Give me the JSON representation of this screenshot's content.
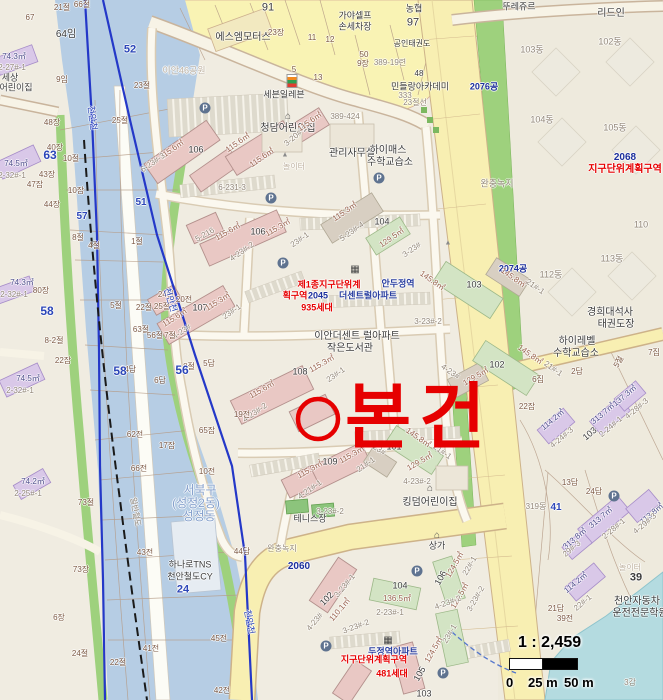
{
  "annotation": {
    "subject": "본건",
    "color": "#e60000"
  },
  "scale": {
    "ratio": "1 : 2,459",
    "t0": "0",
    "t25": "25 m",
    "t50": "50 m"
  },
  "colors": {
    "river_zone": "#b6cde4",
    "boundary_line": "#2438c8",
    "buffer_green": "#9ed17d",
    "road_yellow": "#f8efb2",
    "apartment_pink": "#e9c8c4",
    "building_purple": "#d9c8e8",
    "annotation_red": "#e60000",
    "water": "#b4dbe0",
    "background": "#f0ece1"
  },
  "label_format": [
    "text",
    "x",
    "y",
    "color",
    "size",
    "rotation",
    "bold"
  ],
  "labels": [
    [
      "91",
      268,
      8,
      "dark",
      11,
      0,
      0
    ],
    [
      "66절",
      82,
      5
    ],
    [
      "21절",
      62,
      8
    ],
    [
      "67",
      30,
      18
    ],
    [
      "64임",
      66,
      35,
      "dark",
      10
    ],
    [
      "에스엠모터스",
      243,
      38,
      "dark",
      10
    ],
    [
      "가야셀프",
      355,
      16,
      "dark",
      9
    ],
    [
      "손세차장",
      355,
      27,
      "dark",
      9
    ],
    [
      "농협",
      414,
      9,
      "dark",
      9
    ],
    [
      "97",
      413,
      23,
      "dark",
      11
    ],
    [
      "뚜레쥬르",
      519,
      7,
      "dark",
      9
    ],
    [
      "리드인",
      611,
      14,
      "dark",
      10
    ],
    [
      "공인태권도",
      412,
      44,
      "dark",
      8
    ],
    [
      "50",
      364,
      55
    ],
    [
      "9장",
      363,
      64
    ],
    [
      "389-19련",
      390,
      63,
      "gray"
    ],
    [
      "48",
      419,
      74,
      "dark"
    ],
    [
      "민들랑아카데미",
      420,
      87,
      "dark",
      9
    ],
    [
      "333",
      405,
      96,
      "gray"
    ],
    [
      "23절선",
      415,
      103,
      "gray"
    ],
    [
      "23장",
      276,
      33
    ],
    [
      "11",
      312,
      38
    ],
    [
      "12",
      330,
      40
    ],
    [
      "5",
      294,
      70
    ],
    [
      "13",
      318,
      78
    ],
    [
      "세븐일레븐",
      284,
      95,
      "dark",
      9
    ],
    [
      "이안46공원",
      184,
      71,
      "faint",
      9
    ],
    [
      "102동",
      610,
      42,
      "gray",
      9
    ],
    [
      "103동",
      532,
      50,
      "gray",
      9
    ],
    [
      "104동",
      542,
      120,
      "gray",
      9
    ],
    [
      "105동",
      615,
      128,
      "gray",
      9
    ],
    [
      "2076공",
      484,
      87,
      "navy",
      9,
      0,
      1
    ],
    [
      "완충녹지",
      497,
      184,
      "gray",
      9
    ],
    [
      "청담어린이집",
      288,
      129,
      "dark",
      10
    ],
    [
      "389-424",
      345,
      117,
      "gray"
    ],
    [
      "관리사무실",
      352,
      154,
      "dark",
      10
    ],
    [
      "하이매스",
      388,
      151,
      "dark",
      10
    ],
    [
      "수학교습소",
      390,
      163,
      "dark",
      10
    ],
    [
      "놀이터",
      294,
      167,
      "faint",
      8
    ],
    [
      "110",
      641,
      225,
      "gray",
      9
    ],
    [
      "2074공",
      513,
      269,
      "navy",
      9,
      0,
      1
    ],
    [
      "112동",
      551,
      275,
      "gray",
      9
    ],
    [
      "113동",
      612,
      259,
      "gray",
      9
    ],
    [
      "2068",
      625,
      158,
      "navy",
      10,
      0,
      1
    ],
    [
      "지구단위계획구역",
      625,
      170,
      "red",
      10,
      0,
      1
    ],
    [
      "경희대석사",
      610,
      313,
      "dark",
      10
    ],
    [
      "태권도장",
      616,
      325,
      "dark",
      10
    ],
    [
      "하이레벨",
      577,
      342,
      "dark",
      10
    ],
    [
      "수학교습소",
      576,
      354,
      "dark",
      10
    ],
    [
      "115.6㎡",
      172,
      150,
      "area",
      8,
      -35
    ],
    [
      "106",
      196,
      150,
      "dark",
      9
    ],
    [
      "115.6㎡",
      238,
      143,
      "area",
      8,
      -35
    ],
    [
      "115.6㎡",
      262,
      158,
      "area",
      8,
      -35
    ],
    [
      "6-23#-3",
      153,
      163,
      "gray",
      8,
      -35
    ],
    [
      "3-20#-1",
      296,
      136,
      "gray",
      8,
      -40
    ],
    [
      "115.6㎡",
      310,
      122,
      "area",
      8,
      -35
    ],
    [
      "6-231-3",
      232,
      188,
      "gray"
    ],
    [
      "115.6㎡",
      228,
      232,
      "area",
      8,
      -30
    ],
    [
      "106",
      258,
      232,
      "dark",
      9
    ],
    [
      "115.3㎡",
      278,
      228,
      "area",
      8,
      -30
    ],
    [
      "5-216",
      205,
      235,
      "gray",
      8,
      -30
    ],
    [
      "4-23#-2",
      242,
      252,
      "gray",
      8,
      -35
    ],
    [
      "23#-1",
      300,
      240,
      "gray",
      8,
      -35
    ],
    [
      "115.3㎡",
      345,
      212,
      "area",
      8,
      -35
    ],
    [
      "5-23#-4",
      352,
      232,
      "gray",
      8,
      -35
    ],
    [
      "104",
      382,
      222,
      "dark",
      9
    ],
    [
      "129.5㎡",
      392,
      238,
      "area",
      8,
      -35
    ],
    [
      "3-23#",
      412,
      250,
      "gray",
      8,
      -35
    ],
    [
      "115.6㎡",
      175,
      318,
      "area",
      8,
      -32
    ],
    [
      "107",
      200,
      308,
      "dark",
      9
    ],
    [
      "115.3㎡",
      218,
      302,
      "area",
      8,
      -32
    ],
    [
      "23#-1",
      232,
      312,
      "gray",
      8,
      -35
    ],
    [
      "4-23#",
      182,
      332,
      "gray",
      8,
      -35
    ],
    [
      "제1종지구단위계",
      329,
      285,
      "red",
      9,
      0,
      1
    ],
    [
      "안두정역",
      398,
      284,
      "blue2",
      9,
      0,
      1
    ],
    [
      "획구역",
      295,
      296,
      "red",
      9,
      0,
      1
    ],
    [
      "2045",
      318,
      296,
      "navy",
      9,
      0,
      1
    ],
    [
      "더센트럴아파트",
      368,
      296,
      "blue2",
      9,
      0,
      1
    ],
    [
      "935세대",
      317,
      308,
      "red",
      9,
      0,
      1
    ],
    [
      "이안더센트 럴아파트",
      357,
      337,
      "dark",
      10
    ],
    [
      "작은도서관",
      350,
      349,
      "dark",
      10
    ],
    [
      "3-23#-2",
      428,
      322,
      "gray"
    ],
    [
      "145.8㎡",
      432,
      281,
      "area",
      8,
      35
    ],
    [
      "103",
      474,
      285,
      "dark",
      9
    ],
    [
      "145.8㎡",
      513,
      278,
      "area",
      8,
      35
    ],
    [
      "21#-1",
      535,
      287,
      "gray",
      8,
      35
    ],
    [
      "145.8㎡",
      530,
      355,
      "area",
      8,
      35
    ],
    [
      "102",
      497,
      365,
      "dark",
      9
    ],
    [
      "129.5㎡",
      476,
      377,
      "area",
      8,
      -30
    ],
    [
      "4-23#",
      450,
      372,
      "gray",
      8,
      35
    ],
    [
      "21#-1",
      553,
      369,
      "gray",
      8,
      35
    ],
    [
      "115.6㎡",
      262,
      390,
      "area",
      8,
      -30
    ],
    [
      "108",
      300,
      372,
      "dark",
      9
    ],
    [
      "115.3㎡",
      322,
      364,
      "area",
      8,
      -30
    ],
    [
      "23#-1",
      336,
      375,
      "gray",
      8,
      -35
    ],
    [
      "4-23#-2",
      255,
      413,
      "gray",
      8,
      -35
    ],
    [
      "115.3㎡",
      310,
      470,
      "area",
      8,
      -30
    ],
    [
      "109",
      330,
      462,
      "dark",
      9
    ],
    [
      "115.3㎡",
      352,
      455,
      "area",
      8,
      -30
    ],
    [
      "21#-1",
      366,
      465,
      "gray",
      8,
      -35
    ],
    [
      "4-21#-1",
      310,
      490,
      "gray",
      8,
      -35
    ],
    [
      "3-23#-2",
      330,
      512,
      "gray"
    ],
    [
      "101",
      394,
      447,
      "dark",
      9
    ],
    [
      "145.8㎡",
      418,
      438,
      "area",
      8,
      35
    ],
    [
      "4-23#",
      376,
      448,
      "gray",
      8,
      35
    ],
    [
      "129.5㎡",
      420,
      462,
      "area",
      8,
      -30
    ],
    [
      "21#-1",
      442,
      452,
      "gray",
      8,
      35
    ],
    [
      "테니스장",
      310,
      519,
      "dark",
      9
    ],
    [
      "킹덤어린이집",
      430,
      503,
      "dark",
      10
    ],
    [
      "2060",
      299,
      567,
      "navy",
      10,
      0,
      1
    ],
    [
      "상가",
      437,
      546,
      "dark",
      9
    ],
    [
      "4-23#-2",
      417,
      482,
      "gray"
    ],
    [
      "완충녹지",
      282,
      549,
      "gray",
      8
    ],
    [
      "102",
      327,
      599,
      "dark",
      9,
      -45
    ],
    [
      "110.1㎡",
      340,
      610,
      "area",
      8,
      -50
    ],
    [
      "4-23#",
      315,
      622,
      "gray",
      8,
      -50
    ],
    [
      "3-23#-1",
      345,
      586,
      "gray",
      8,
      -50
    ],
    [
      "104",
      400,
      586,
      "dark",
      9
    ],
    [
      "136.5㎡",
      397,
      599,
      "area",
      8
    ],
    [
      "2-23#-1",
      390,
      613,
      "gray"
    ],
    [
      "3-23#-2",
      356,
      627,
      "gray",
      8,
      -20
    ],
    [
      "106",
      441,
      578,
      "dark",
      9,
      -60
    ],
    [
      "124.5㎡",
      455,
      565,
      "area",
      8,
      -60
    ],
    [
      "22#-1",
      470,
      566,
      "gray",
      8,
      -60
    ],
    [
      "124.5㎡",
      460,
      596,
      "area",
      8,
      -60
    ],
    [
      "4-23#-2",
      448,
      603,
      "gray",
      8,
      -20
    ],
    [
      "3-23#-2",
      476,
      599,
      "gray",
      8,
      -60
    ],
    [
      "105",
      420,
      674,
      "dark",
      9,
      -60
    ],
    [
      "124.5㎡",
      434,
      650,
      "area",
      8,
      -60
    ],
    [
      "23#-1",
      450,
      634,
      "gray",
      8,
      -60
    ],
    [
      "103",
      424,
      694,
      "dark",
      9
    ],
    [
      "두정역아파트",
      393,
      652,
      "blue2",
      9,
      0,
      1
    ],
    [
      "지구단위계획구역",
      374,
      660,
      "red",
      9,
      0,
      1
    ],
    [
      "481세대",
      392,
      674,
      "red",
      9,
      0,
      1
    ],
    [
      "74.3㎡",
      14,
      57,
      "area2"
    ],
    [
      "2-27#-1",
      12,
      68,
      "gray"
    ],
    [
      "세상",
      10,
      78,
      "dark",
      9
    ],
    [
      "어린이집",
      16,
      88,
      "dark",
      9
    ],
    [
      "74.5㎡",
      16,
      164,
      "area2"
    ],
    [
      "2-32#-1",
      12,
      176,
      "gray"
    ],
    [
      "74.3㎡",
      22,
      283,
      "area2"
    ],
    [
      "2-32#-1",
      14,
      295,
      "gray"
    ],
    [
      "74.5㎡",
      28,
      379,
      "area2"
    ],
    [
      "2-32#-1",
      20,
      391,
      "gray"
    ],
    [
      "74.2㎡",
      33,
      482,
      "area2"
    ],
    [
      "2-25#-1",
      28,
      494,
      "gray"
    ],
    [
      "9임",
      62,
      80
    ],
    [
      "52",
      130,
      50,
      "blue",
      11,
      0,
      1
    ],
    [
      "23절",
      142,
      86
    ],
    [
      "25절",
      120,
      121
    ],
    [
      "10절",
      71,
      159
    ],
    [
      "48장",
      52,
      123
    ],
    [
      "40장",
      55,
      148
    ],
    [
      "63",
      50,
      155,
      "blue",
      12,
      0,
      1
    ],
    [
      "43장",
      47,
      175
    ],
    [
      "47잡",
      35,
      185
    ],
    [
      "44장",
      52,
      205
    ],
    [
      "10잡",
      76,
      191
    ],
    [
      "57",
      82,
      217,
      "blue",
      10,
      0,
      1
    ],
    [
      "51",
      141,
      203,
      "blue",
      10,
      0,
      1
    ],
    [
      "58",
      47,
      311,
      "blue",
      12,
      0,
      1
    ],
    [
      "80장",
      41,
      291
    ],
    [
      "8-2절",
      54,
      341
    ],
    [
      "22잡",
      63,
      361
    ],
    [
      "8절",
      78,
      238
    ],
    [
      "4절",
      94,
      246
    ],
    [
      "1절",
      137,
      242
    ],
    [
      "24절",
      166,
      295
    ],
    [
      "20전",
      184,
      300
    ],
    [
      "22절",
      144,
      308
    ],
    [
      "25절",
      162,
      307
    ],
    [
      "5절",
      116,
      306
    ],
    [
      "63절",
      141,
      330
    ],
    [
      "56절",
      155,
      336
    ],
    [
      "7절",
      170,
      336
    ],
    [
      "8절",
      189,
      367
    ],
    [
      "5답",
      209,
      364
    ],
    [
      "64답",
      128,
      370
    ],
    [
      "6답",
      160,
      381
    ],
    [
      "58",
      120,
      371,
      "blue",
      12,
      0,
      1
    ],
    [
      "56",
      182,
      370,
      "blue",
      12,
      0,
      1
    ],
    [
      "65잡",
      207,
      431
    ],
    [
      "62전",
      135,
      435
    ],
    [
      "17잡",
      167,
      446
    ],
    [
      "19전",
      242,
      415
    ],
    [
      "66전",
      139,
      469
    ],
    [
      "10전",
      207,
      472
    ],
    [
      "73절",
      86,
      503
    ],
    [
      "73장",
      81,
      570
    ],
    [
      "43전",
      145,
      553
    ],
    [
      "44답",
      242,
      552
    ],
    [
      "45전",
      219,
      639
    ],
    [
      "41전",
      151,
      649
    ],
    [
      "22절",
      118,
      663
    ],
    [
      "42전",
      222,
      691
    ],
    [
      "6장",
      59,
      618
    ],
    [
      "24절",
      80,
      654
    ],
    [
      "일반철도",
      135,
      512,
      "gray",
      8,
      80
    ],
    [
      "천안천",
      92,
      118,
      "blue",
      9,
      83
    ],
    [
      "천안천",
      170,
      300,
      "blue",
      9,
      72
    ],
    [
      "천안천",
      249,
      622,
      "blue",
      9,
      80
    ],
    [
      "서북구",
      200,
      490,
      "river",
      12
    ],
    [
      "(성정2동)",
      196,
      503,
      "river",
      12
    ],
    [
      "성정동",
      199,
      516,
      "river",
      12
    ],
    [
      "하나로TNS",
      190,
      565,
      "dark",
      9
    ],
    [
      "천안철도CY",
      190,
      577,
      "dark",
      9
    ],
    [
      "24",
      183,
      590,
      "blue",
      11,
      0,
      1
    ],
    [
      "13답",
      570,
      483
    ],
    [
      "24답",
      594,
      492
    ],
    [
      "41",
      556,
      508,
      "blue",
      10,
      0,
      1
    ],
    [
      "319동",
      536,
      507,
      "gray"
    ],
    [
      "113.8㎡",
      652,
      514,
      "area2",
      8,
      -40
    ],
    [
      "313.7㎡",
      601,
      518,
      "area2",
      8,
      -40
    ],
    [
      "2-28#-1",
      614,
      529,
      "gray",
      8,
      -40
    ],
    [
      "313.8㎡",
      575,
      539,
      "area2",
      8,
      -40
    ],
    [
      "29#-3",
      572,
      549,
      "gray",
      8,
      -40
    ],
    [
      "4-29#-3",
      645,
      524,
      "gray",
      8,
      -40
    ],
    [
      "114.2㎡",
      576,
      583,
      "area2",
      8,
      -40
    ],
    [
      "22#-1",
      583,
      603,
      "gray",
      8,
      -40
    ],
    [
      "21답",
      556,
      609
    ],
    [
      "39전",
      565,
      619
    ],
    [
      "놀이터",
      630,
      568,
      "faint"
    ],
    [
      "39",
      636,
      578,
      "dark",
      11,
      0,
      1
    ],
    [
      "천안자동차",
      637,
      602,
      "dark",
      10
    ],
    [
      "운전전문학원",
      640,
      614,
      "dark",
      10
    ],
    [
      "313.7㎡",
      603,
      414,
      "area2",
      8,
      -40
    ],
    [
      "2-24#-1",
      611,
      427,
      "gray",
      8,
      -40
    ],
    [
      "114.2㎡",
      553,
      420,
      "area2",
      8,
      -40
    ],
    [
      "4-24#-3",
      562,
      438,
      "gray",
      8,
      -40
    ],
    [
      "137.3㎡",
      625,
      396,
      "area2",
      8,
      -40
    ],
    [
      "4-28#-3",
      637,
      409,
      "gray",
      8,
      -40
    ],
    [
      "103",
      590,
      434,
      "dark",
      9,
      -40
    ],
    [
      "6집",
      538,
      380
    ],
    [
      "2답",
      577,
      372
    ],
    [
      "5절",
      619,
      362,
      "brown",
      8,
      -60
    ],
    [
      "7집",
      654,
      353
    ],
    [
      "22잡",
      527,
      407
    ],
    [
      "3감",
      630,
      683,
      "gray"
    ]
  ],
  "icon_format": [
    "kind",
    "glyph",
    "x",
    "y"
  ],
  "icons": [
    [
      "seven-eleven",
      "",
      292,
      81
    ],
    [
      "parking",
      "P",
      205,
      108
    ],
    [
      "parking",
      "P",
      271,
      198
    ],
    [
      "parking",
      "P",
      379,
      178
    ],
    [
      "parking",
      "P",
      283,
      263
    ],
    [
      "parking",
      "P",
      417,
      571
    ],
    [
      "parking",
      "P",
      326,
      646
    ],
    [
      "parking",
      "P",
      443,
      673
    ],
    [
      "parking",
      "P",
      614,
      496
    ],
    [
      "building",
      "▦",
      355,
      270
    ],
    [
      "building",
      "▦",
      388,
      641
    ],
    [
      "house",
      "⌂",
      288,
      117
    ],
    [
      "house",
      "⌂",
      430,
      489
    ],
    [
      "house",
      "⌂",
      437,
      536
    ],
    [
      "playground",
      "▲",
      285,
      155
    ],
    [
      "playground",
      "▲",
      448,
      243
    ]
  ]
}
